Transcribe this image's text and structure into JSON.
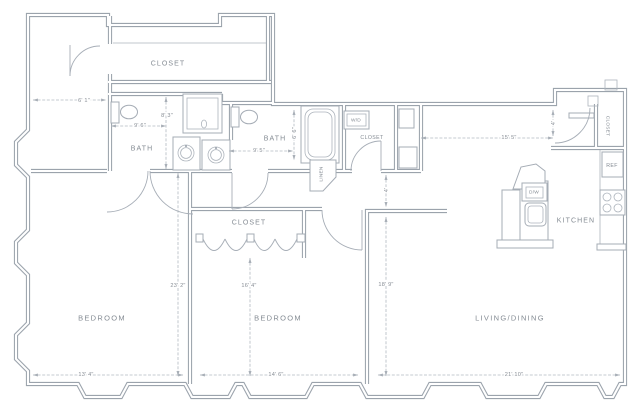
{
  "rooms": {
    "closet_top": "CLOSET",
    "bath1": "BATH",
    "bath2": "BATH",
    "linen": "LINEN",
    "wd_closet": "CLOSET",
    "entry_closet": "CLOSET",
    "kitchen": "KITCHEN",
    "bedroom2_closet": "CLOSET",
    "bedroom1": "BEDROOM",
    "bedroom2": "BEDROOM",
    "living": "LIVING/DINING"
  },
  "appliances": {
    "washer_dryer": "W/D",
    "refrigerator": "REF",
    "dishwasher": "D/W"
  },
  "dims": {
    "entry_hall": "6' 1\"",
    "bath1_w": "9' 6\"",
    "bath1_d": "8' 3\"",
    "bath2_w": "9' 5\"",
    "bath2_d": "6' 6\"",
    "foyer_hall": "15' 5\"",
    "foyer_w": "4'",
    "hall_w": "4'",
    "bed1_d": "23' 2\"",
    "bed2_closet": "16' 4\"",
    "living_d": "18' 9\"",
    "bed1_w": "13' 4\"",
    "bed2_w": "14' 6\"",
    "living_w": "21' 10\""
  },
  "colors": {
    "wall": "#9ba3ac",
    "text": "#848b93",
    "dimension": "#b3bac1"
  }
}
